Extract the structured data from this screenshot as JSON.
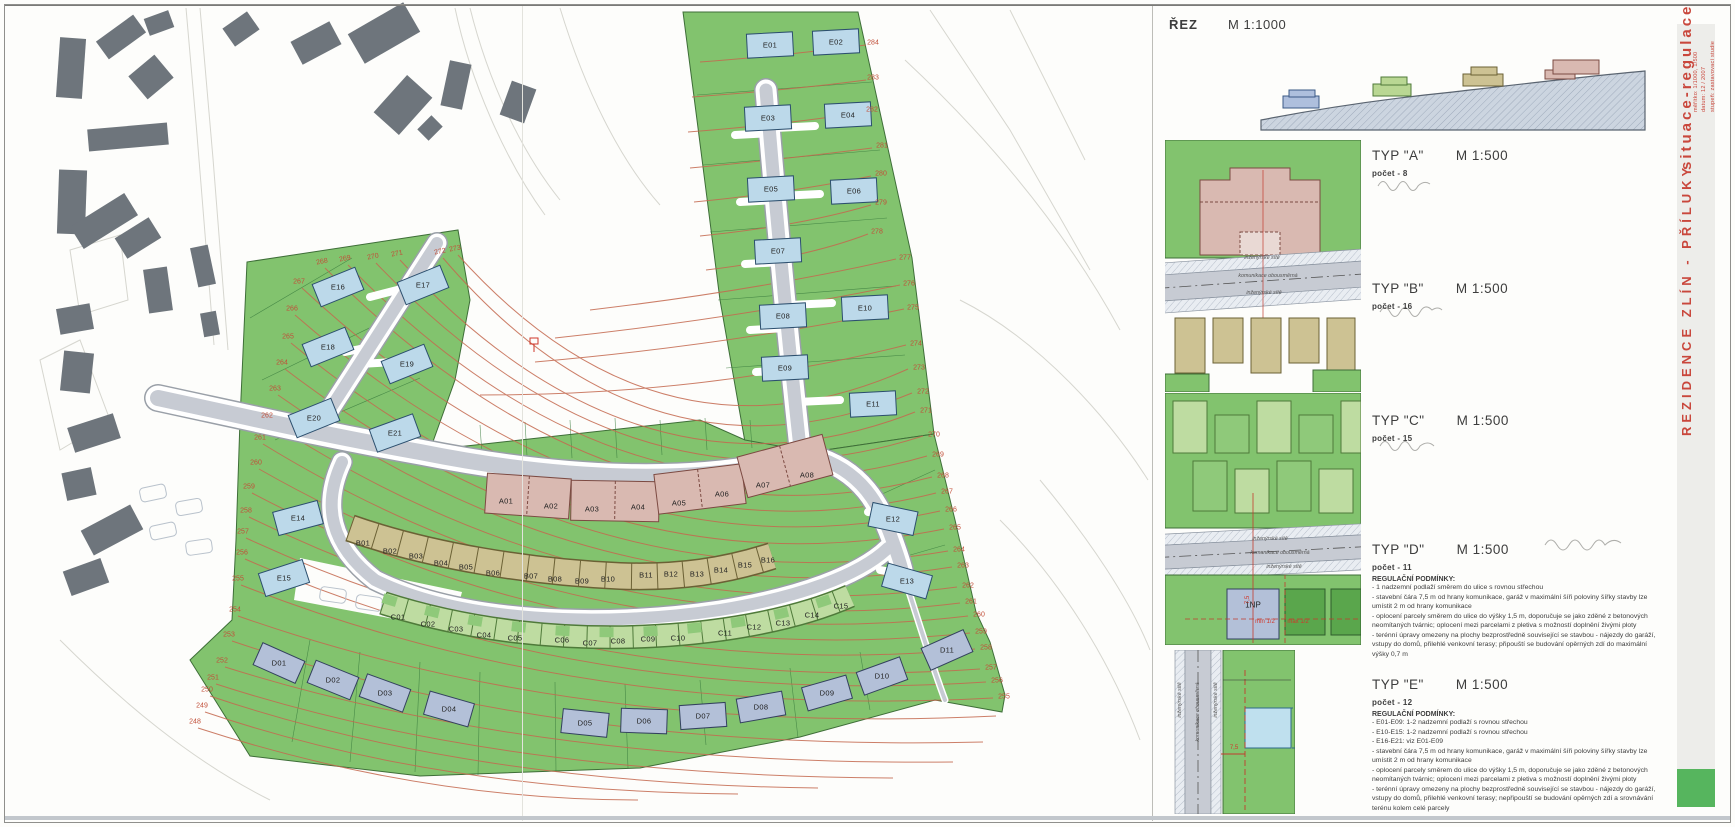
{
  "colors": {
    "accent_red": "#c9473c",
    "map_green": "#82c36e",
    "contour": "#c4694f",
    "type_a_pink": "#d9b9b1",
    "type_b_tan": "#cdc293",
    "type_c_green": "#bedca1",
    "type_d_blue": "#b3c0d8",
    "type_e_blue": "#bcd9ea",
    "road_gray": "#c7cbd3",
    "existing_building_gray": "#6e757c"
  },
  "section": {
    "title": "ŘEZ",
    "scale": "M 1:1000"
  },
  "sidebar": {
    "title": "situace-regulace",
    "meta_line1": "měřítko: 1/1000, 1/500",
    "meta_line2": "datum: 12 / 2007",
    "meta_line3": "stupeň: zastavovací studie",
    "project": "REZIDENCE ZLÍN - PŘÍLUKY"
  },
  "detail_labels": {
    "utilities": "inženýrské sítě",
    "road": "komunikace obousměrná",
    "floor_label": "1NP",
    "dim_setback": "7,5",
    "dim_min": "min 1/2",
    "dim_max": "max 1/2"
  },
  "types": [
    {
      "id": "A",
      "title": "TYP \"A\"",
      "scale": "M 1:500",
      "count_label": "počet - 8",
      "regulations_title": "",
      "regulations": []
    },
    {
      "id": "B",
      "title": "TYP \"B\"",
      "scale": "M 1:500",
      "count_label": "počet - 16",
      "regulations_title": "",
      "regulations": []
    },
    {
      "id": "C",
      "title": "TYP \"C\"",
      "scale": "M 1:500",
      "count_label": "počet - 15",
      "regulations_title": "",
      "regulations": []
    },
    {
      "id": "D",
      "title": "TYP \"D\"",
      "scale": "M 1:500",
      "count_label": "počet - 11",
      "regulations_title": "REGULAČNÍ PODMÍNKY:",
      "regulations": [
        "- 1 nadzemní podlaží směrem do ulice s rovnou střechou",
        "- stavební čára 7,5 m od hrany komunikace, garáž v maximální šíři poloviny šířky stavby lze umístit 2 m od hrany komunikace",
        "- oplocení parcely směrem do ulice do výšky 1,5 m, doporučuje se jako zděné z betonových neomítaných tvárnic; oplocení mezi parcelami z pletiva s možností doplnění živými ploty",
        "- terénní úpravy omezeny na plochy bezprostředně související se stavbou - nájezdy do garáží, vstupy do domů, přilehlé venkovní terasy; připouští se budování opěrných zdí do maximální výšky 0,7 m"
      ]
    },
    {
      "id": "E",
      "title": "TYP \"E\"",
      "scale": "M 1:500",
      "count_label": "počet - 12",
      "regulations_title": "REGULAČNÍ PODMÍNKY:",
      "regulations": [
        "- E01-E09: 1-2 nadzemní podlaží s rovnou střechou",
        "- E10-E15: 1-2 nadzemní podlaží s rovnou střechou",
        "- E16-E21: viz E01-E09",
        "- stavební čára 7,5 m od hrany komunikace, garáž v maximální šíři poloviny šířky stavby lze umístit 2 m od hrany komunikace",
        "- oplocení parcely směrem do ulice do výšky 1,5 m, doporučuje se jako zděné z betonových neomítaných tvárnic; oplocení mezi parcelami z pletiva s možností doplnění živými ploty",
        "- terénní úpravy omezeny na plochy bezprostředně související se stavbou - nájezdy do garáží, vstupy do domů, přilehlé venkovní terasy; nepřipouští se budování opěrných zdí a srovnávání terénu kolem celé parcely"
      ]
    }
  ],
  "map": {
    "parcels": [
      {
        "id": "E01",
        "x": 770,
        "y": 45,
        "t": "E"
      },
      {
        "id": "E02",
        "x": 836,
        "y": 42,
        "t": "E"
      },
      {
        "id": "E03",
        "x": 768,
        "y": 118,
        "t": "E"
      },
      {
        "id": "E04",
        "x": 848,
        "y": 115,
        "t": "E"
      },
      {
        "id": "E05",
        "x": 771,
        "y": 189,
        "t": "E"
      },
      {
        "id": "E06",
        "x": 854,
        "y": 191,
        "t": "E"
      },
      {
        "id": "E07",
        "x": 778,
        "y": 251,
        "t": "E"
      },
      {
        "id": "E08",
        "x": 783,
        "y": 316,
        "t": "E"
      },
      {
        "id": "E09",
        "x": 785,
        "y": 368,
        "t": "E"
      },
      {
        "id": "E10",
        "x": 865,
        "y": 308,
        "t": "E"
      },
      {
        "id": "E11",
        "x": 873,
        "y": 404,
        "t": "E"
      },
      {
        "id": "E12",
        "x": 893,
        "y": 519,
        "t": "E"
      },
      {
        "id": "E13",
        "x": 907,
        "y": 581,
        "t": "E"
      },
      {
        "id": "E14",
        "x": 298,
        "y": 518,
        "t": "E"
      },
      {
        "id": "E15",
        "x": 284,
        "y": 578,
        "t": "E"
      },
      {
        "id": "E16",
        "x": 338,
        "y": 287,
        "t": "E"
      },
      {
        "id": "E17",
        "x": 423,
        "y": 285,
        "t": "E"
      },
      {
        "id": "E18",
        "x": 328,
        "y": 347,
        "t": "E"
      },
      {
        "id": "E19",
        "x": 407,
        "y": 364,
        "t": "E"
      },
      {
        "id": "E20",
        "x": 314,
        "y": 418,
        "t": "E"
      },
      {
        "id": "E21",
        "x": 395,
        "y": 433,
        "t": "E"
      },
      {
        "id": "A01",
        "x": 506,
        "y": 501,
        "t": "A"
      },
      {
        "id": "A02",
        "x": 551,
        "y": 506,
        "t": "A"
      },
      {
        "id": "A03",
        "x": 592,
        "y": 509,
        "t": "A"
      },
      {
        "id": "A04",
        "x": 638,
        "y": 507,
        "t": "A"
      },
      {
        "id": "A05",
        "x": 679,
        "y": 503,
        "t": "A"
      },
      {
        "id": "A06",
        "x": 722,
        "y": 494,
        "t": "A"
      },
      {
        "id": "A07",
        "x": 763,
        "y": 485,
        "t": "A"
      },
      {
        "id": "A08",
        "x": 807,
        "y": 475,
        "t": "A"
      },
      {
        "id": "B01",
        "x": 363,
        "y": 543,
        "t": "B"
      },
      {
        "id": "B02",
        "x": 390,
        "y": 551,
        "t": "B"
      },
      {
        "id": "B03",
        "x": 416,
        "y": 556,
        "t": "B"
      },
      {
        "id": "B04",
        "x": 441,
        "y": 563,
        "t": "B"
      },
      {
        "id": "B05",
        "x": 466,
        "y": 567,
        "t": "B"
      },
      {
        "id": "B06",
        "x": 493,
        "y": 573,
        "t": "B"
      },
      {
        "id": "B07",
        "x": 531,
        "y": 576,
        "t": "B"
      },
      {
        "id": "B08",
        "x": 555,
        "y": 579,
        "t": "B"
      },
      {
        "id": "B09",
        "x": 582,
        "y": 581,
        "t": "B"
      },
      {
        "id": "B10",
        "x": 608,
        "y": 579,
        "t": "B"
      },
      {
        "id": "B11",
        "x": 646,
        "y": 575,
        "t": "B"
      },
      {
        "id": "B12",
        "x": 671,
        "y": 574,
        "t": "B"
      },
      {
        "id": "B13",
        "x": 697,
        "y": 574,
        "t": "B"
      },
      {
        "id": "B14",
        "x": 721,
        "y": 570,
        "t": "B"
      },
      {
        "id": "B15",
        "x": 745,
        "y": 565,
        "t": "B"
      },
      {
        "id": "B16",
        "x": 768,
        "y": 560,
        "t": "B"
      },
      {
        "id": "C01",
        "x": 398,
        "y": 617,
        "t": "C"
      },
      {
        "id": "C02",
        "x": 428,
        "y": 624,
        "t": "C"
      },
      {
        "id": "C03",
        "x": 456,
        "y": 629,
        "t": "C"
      },
      {
        "id": "C04",
        "x": 484,
        "y": 635,
        "t": "C"
      },
      {
        "id": "C05",
        "x": 515,
        "y": 638,
        "t": "C"
      },
      {
        "id": "C06",
        "x": 562,
        "y": 640,
        "t": "C"
      },
      {
        "id": "C07",
        "x": 590,
        "y": 643,
        "t": "C"
      },
      {
        "id": "C08",
        "x": 618,
        "y": 641,
        "t": "C"
      },
      {
        "id": "C09",
        "x": 648,
        "y": 639,
        "t": "C"
      },
      {
        "id": "C10",
        "x": 678,
        "y": 638,
        "t": "C"
      },
      {
        "id": "C11",
        "x": 725,
        "y": 633,
        "t": "C"
      },
      {
        "id": "C12",
        "x": 754,
        "y": 627,
        "t": "C"
      },
      {
        "id": "C13",
        "x": 783,
        "y": 623,
        "t": "C"
      },
      {
        "id": "C14",
        "x": 812,
        "y": 615,
        "t": "C"
      },
      {
        "id": "C15",
        "x": 841,
        "y": 606,
        "t": "C"
      },
      {
        "id": "D01",
        "x": 279,
        "y": 663,
        "t": "D"
      },
      {
        "id": "D02",
        "x": 333,
        "y": 680,
        "t": "D"
      },
      {
        "id": "D03",
        "x": 385,
        "y": 693,
        "t": "D"
      },
      {
        "id": "D04",
        "x": 449,
        "y": 709,
        "t": "D"
      },
      {
        "id": "D05",
        "x": 585,
        "y": 723,
        "t": "D"
      },
      {
        "id": "D06",
        "x": 644,
        "y": 721,
        "t": "D"
      },
      {
        "id": "D07",
        "x": 703,
        "y": 716,
        "t": "D"
      },
      {
        "id": "D08",
        "x": 761,
        "y": 707,
        "t": "D"
      },
      {
        "id": "D09",
        "x": 827,
        "y": 693,
        "t": "D"
      },
      {
        "id": "D10",
        "x": 882,
        "y": 676,
        "t": "D"
      },
      {
        "id": "D11",
        "x": 947,
        "y": 650,
        "t": "D"
      }
    ],
    "contour_labels": [
      {
        "v": "284",
        "x": 873,
        "y": 43
      },
      {
        "v": "283",
        "x": 873,
        "y": 78
      },
      {
        "v": "282",
        "x": 872,
        "y": 110
      },
      {
        "v": "281",
        "x": 882,
        "y": 146
      },
      {
        "v": "280",
        "x": 881,
        "y": 174
      },
      {
        "v": "279",
        "x": 881,
        "y": 203
      },
      {
        "v": "278",
        "x": 877,
        "y": 232
      },
      {
        "v": "277",
        "x": 905,
        "y": 258
      },
      {
        "v": "276",
        "x": 909,
        "y": 284
      },
      {
        "v": "275",
        "x": 913,
        "y": 308
      },
      {
        "v": "274",
        "x": 916,
        "y": 344
      },
      {
        "v": "273",
        "x": 919,
        "y": 368
      },
      {
        "v": "272",
        "x": 923,
        "y": 392
      },
      {
        "v": "271",
        "x": 926,
        "y": 411
      },
      {
        "v": "270",
        "x": 934,
        "y": 435
      },
      {
        "v": "269",
        "x": 938,
        "y": 455
      },
      {
        "v": "268",
        "x": 943,
        "y": 476
      },
      {
        "v": "267",
        "x": 947,
        "y": 492
      },
      {
        "v": "266",
        "x": 951,
        "y": 510
      },
      {
        "v": "265",
        "x": 955,
        "y": 528
      },
      {
        "v": "264",
        "x": 959,
        "y": 550
      },
      {
        "v": "263",
        "x": 963,
        "y": 566
      },
      {
        "v": "262",
        "x": 968,
        "y": 586
      },
      {
        "v": "261",
        "x": 971,
        "y": 602
      },
      {
        "v": "260",
        "x": 979,
        "y": 615
      },
      {
        "v": "259",
        "x": 981,
        "y": 632
      },
      {
        "v": "258",
        "x": 986,
        "y": 648
      },
      {
        "v": "257",
        "x": 991,
        "y": 668
      },
      {
        "v": "256",
        "x": 997,
        "y": 681
      },
      {
        "v": "255",
        "x": 1004,
        "y": 697
      },
      {
        "v": "268",
        "x": 322,
        "y": 262,
        "r": -12
      },
      {
        "v": "269",
        "x": 345,
        "y": 259,
        "r": -12
      },
      {
        "v": "270",
        "x": 373,
        "y": 257,
        "r": -12
      },
      {
        "v": "271",
        "x": 397,
        "y": 254,
        "r": -12
      },
      {
        "v": "272",
        "x": 440,
        "y": 252,
        "r": -12
      },
      {
        "v": "273",
        "x": 455,
        "y": 249,
        "r": -12
      },
      {
        "v": "267",
        "x": 299,
        "y": 282
      },
      {
        "v": "266",
        "x": 292,
        "y": 309
      },
      {
        "v": "265",
        "x": 288,
        "y": 337
      },
      {
        "v": "264",
        "x": 282,
        "y": 363
      },
      {
        "v": "263",
        "x": 275,
        "y": 389
      },
      {
        "v": "262",
        "x": 267,
        "y": 416
      },
      {
        "v": "261",
        "x": 260,
        "y": 438
      },
      {
        "v": "260",
        "x": 256,
        "y": 463
      },
      {
        "v": "259",
        "x": 249,
        "y": 487
      },
      {
        "v": "258",
        "x": 246,
        "y": 511
      },
      {
        "v": "257",
        "x": 243,
        "y": 532
      },
      {
        "v": "256",
        "x": 242,
        "y": 553
      },
      {
        "v": "255",
        "x": 238,
        "y": 579
      },
      {
        "v": "254",
        "x": 235,
        "y": 610
      },
      {
        "v": "253",
        "x": 229,
        "y": 635
      },
      {
        "v": "252",
        "x": 222,
        "y": 661
      },
      {
        "v": "251",
        "x": 213,
        "y": 678
      },
      {
        "v": "250",
        "x": 207,
        "y": 690
      },
      {
        "v": "249",
        "x": 202,
        "y": 706
      },
      {
        "v": "248",
        "x": 195,
        "y": 722
      }
    ]
  }
}
